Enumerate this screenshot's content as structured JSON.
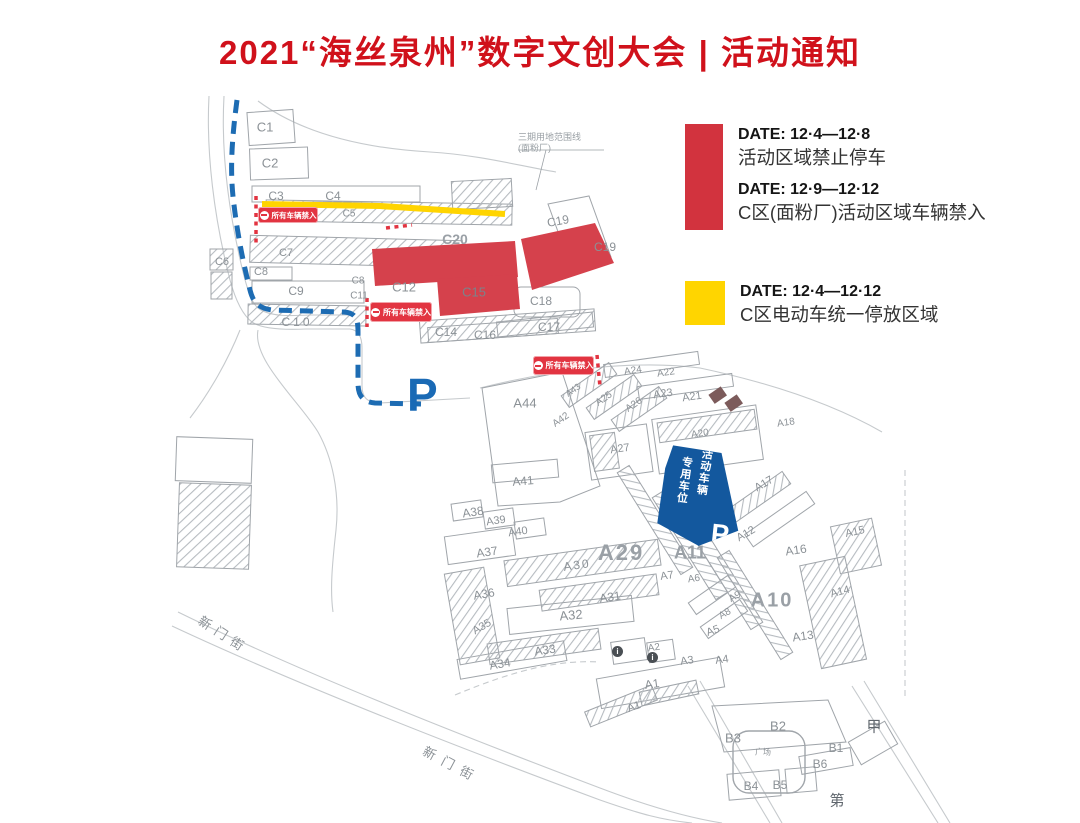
{
  "title": "2021“海丝泉州”数字文创大会 | 活动通知",
  "legend": {
    "no_parking": {
      "color": "#d2333e",
      "entries": [
        {
          "date": "DATE:  12·4—12·8",
          "desc": "活动区域禁止停车"
        },
        {
          "date": "DATE:  12·9—12·12",
          "desc": "C区(面粉厂)活动区域车辆禁入"
        }
      ]
    },
    "ebike": {
      "color": "#ffd500",
      "entries": [
        {
          "date": "DATE:  12·4—12·12",
          "desc": "C区电动车统一停放区域"
        }
      ]
    }
  },
  "map": {
    "no_entry_badge_label": "所有车辆禁入",
    "parking_zone": {
      "col_right": "活动车辆",
      "col_left": "专用车位",
      "p": "P"
    },
    "parking_marker": "P",
    "site_note_line1": "三期用地范围线",
    "site_note_line2": "(面粉厂)",
    "info_icon_glyph": "i",
    "colors": {
      "restricted_red": "#d5414c",
      "ebike_yellow": "#ffd400",
      "route_blue": "#1d6cb3"
    },
    "badges": [
      {
        "x": 258,
        "y": 207,
        "w": 60,
        "h": 16,
        "fs": 7.5
      },
      {
        "x": 370,
        "y": 302,
        "w": 62,
        "h": 20,
        "fs": 8
      },
      {
        "x": 533,
        "y": 356,
        "w": 61,
        "h": 19,
        "fs": 8
      }
    ],
    "info_icons": [
      {
        "x": 612,
        "y": 646
      },
      {
        "x": 647,
        "y": 652
      }
    ],
    "labels": [
      {
        "t": "C1",
        "x": 265,
        "y": 127,
        "s": 13
      },
      {
        "t": "C2",
        "x": 270,
        "y": 163,
        "s": 13
      },
      {
        "t": "C3",
        "x": 276,
        "y": 196,
        "s": 12
      },
      {
        "t": "C4",
        "x": 333,
        "y": 196,
        "s": 12
      },
      {
        "t": "C5",
        "x": 349,
        "y": 214,
        "s": 10
      },
      {
        "t": "C6",
        "x": 222,
        "y": 262,
        "s": 11
      },
      {
        "t": "C7",
        "x": 286,
        "y": 253,
        "s": 11
      },
      {
        "t": "C8",
        "x": 261,
        "y": 272,
        "s": 11
      },
      {
        "t": "C8",
        "x": 358,
        "y": 281,
        "s": 10
      },
      {
        "t": "C9",
        "x": 296,
        "y": 291,
        "s": 12
      },
      {
        "t": "C10",
        "x": 297,
        "y": 322,
        "s": 12,
        "ls": 3
      },
      {
        "t": "C11",
        "x": 359,
        "y": 296,
        "s": 10
      },
      {
        "t": "C12",
        "x": 404,
        "y": 287,
        "s": 13
      },
      {
        "t": "C14",
        "x": 446,
        "y": 332,
        "s": 12
      },
      {
        "t": "C15",
        "x": 474,
        "y": 292,
        "s": 13,
        "c": "#7c828a"
      },
      {
        "t": "C16",
        "x": 485,
        "y": 335,
        "s": 12
      },
      {
        "t": "C17",
        "x": 549,
        "y": 327,
        "s": 12
      },
      {
        "t": "C18",
        "x": 541,
        "y": 301,
        "s": 12
      },
      {
        "t": "C19",
        "x": 558,
        "y": 221,
        "s": 12,
        "r": -10
      },
      {
        "t": "C19",
        "x": 605,
        "y": 247,
        "s": 12
      },
      {
        "t": "C20",
        "x": 455,
        "y": 239,
        "s": 14,
        "b": true
      },
      {
        "t": "A44",
        "x": 525,
        "y": 403,
        "s": 13
      },
      {
        "t": "A24",
        "x": 633,
        "y": 371,
        "s": 10,
        "r": -8
      },
      {
        "t": "A22",
        "x": 666,
        "y": 373,
        "s": 10,
        "r": -8
      },
      {
        "t": "A23",
        "x": 663,
        "y": 394,
        "s": 11,
        "r": -8
      },
      {
        "t": "A21",
        "x": 692,
        "y": 397,
        "s": 11,
        "r": -8
      },
      {
        "t": "A43",
        "x": 573,
        "y": 390,
        "s": 9,
        "r": -35
      },
      {
        "t": "A25",
        "x": 604,
        "y": 399,
        "s": 10,
        "r": -35
      },
      {
        "t": "A26",
        "x": 634,
        "y": 405,
        "s": 10,
        "r": -35
      },
      {
        "t": "A42",
        "x": 561,
        "y": 420,
        "s": 10,
        "r": -35
      },
      {
        "t": "A27",
        "x": 620,
        "y": 449,
        "s": 11,
        "r": -8
      },
      {
        "t": "A20",
        "x": 700,
        "y": 434,
        "s": 10,
        "r": -8
      },
      {
        "t": "A18",
        "x": 786,
        "y": 423,
        "s": 10,
        "r": -8
      },
      {
        "t": "A17",
        "x": 764,
        "y": 484,
        "s": 11,
        "r": -30
      },
      {
        "t": "A12",
        "x": 746,
        "y": 534,
        "s": 11,
        "r": -30
      },
      {
        "t": "A16",
        "x": 796,
        "y": 550,
        "s": 12,
        "r": -8
      },
      {
        "t": "A15",
        "x": 855,
        "y": 532,
        "s": 11,
        "r": -12
      },
      {
        "t": "A14",
        "x": 840,
        "y": 592,
        "s": 11,
        "r": -15
      },
      {
        "t": "A13",
        "x": 803,
        "y": 636,
        "s": 12,
        "r": -8
      },
      {
        "t": "A10",
        "x": 772,
        "y": 601,
        "s": 20,
        "b": true,
        "ls": 2
      },
      {
        "t": "A11",
        "x": 690,
        "y": 553,
        "s": 18,
        "b": true
      },
      {
        "t": "A29",
        "x": 621,
        "y": 553,
        "s": 22,
        "b": true,
        "ls": 2
      },
      {
        "t": "A30",
        "x": 577,
        "y": 565,
        "s": 12,
        "r": -8,
        "ls": 2
      },
      {
        "t": "A31",
        "x": 610,
        "y": 597,
        "s": 12,
        "r": -8
      },
      {
        "t": "A32",
        "x": 571,
        "y": 615,
        "s": 13,
        "r": -5
      },
      {
        "t": "A33",
        "x": 545,
        "y": 650,
        "s": 12,
        "r": -8
      },
      {
        "t": "A34",
        "x": 500,
        "y": 664,
        "s": 12,
        "r": -10
      },
      {
        "t": "A35",
        "x": 482,
        "y": 627,
        "s": 11,
        "r": -30
      },
      {
        "t": "A36",
        "x": 484,
        "y": 594,
        "s": 12,
        "r": -10
      },
      {
        "t": "A37",
        "x": 487,
        "y": 552,
        "s": 12,
        "r": -8
      },
      {
        "t": "A38",
        "x": 473,
        "y": 512,
        "s": 12,
        "r": -8
      },
      {
        "t": "A39",
        "x": 496,
        "y": 521,
        "s": 11,
        "r": -8
      },
      {
        "t": "A40",
        "x": 518,
        "y": 532,
        "s": 11,
        "r": -8
      },
      {
        "t": "A41",
        "x": 523,
        "y": 481,
        "s": 12,
        "r": -5
      },
      {
        "t": "A9",
        "x": 735,
        "y": 597,
        "s": 10,
        "r": -30
      },
      {
        "t": "A8",
        "x": 725,
        "y": 614,
        "s": 10,
        "r": -30
      },
      {
        "t": "A7",
        "x": 667,
        "y": 576,
        "s": 11,
        "r": -8
      },
      {
        "t": "A6",
        "x": 694,
        "y": 579,
        "s": 10,
        "r": -8
      },
      {
        "t": "A5",
        "x": 713,
        "y": 631,
        "s": 11,
        "r": -20
      },
      {
        "t": "A4",
        "x": 722,
        "y": 660,
        "s": 11,
        "r": -8
      },
      {
        "t": "A3",
        "x": 687,
        "y": 661,
        "s": 11,
        "r": -8
      },
      {
        "t": "A2",
        "x": 654,
        "y": 648,
        "s": 10,
        "r": -8
      },
      {
        "t": "A1",
        "x": 652,
        "y": 684,
        "s": 12,
        "r": -8
      },
      {
        "t": "A1",
        "x": 634,
        "y": 707,
        "s": 11,
        "r": -20
      },
      {
        "t": "B2",
        "x": 778,
        "y": 726,
        "s": 13
      },
      {
        "t": "B3",
        "x": 733,
        "y": 738,
        "s": 13
      },
      {
        "t": "B1",
        "x": 836,
        "y": 748,
        "s": 12
      },
      {
        "t": "B6",
        "x": 820,
        "y": 764,
        "s": 12
      },
      {
        "t": "B4",
        "x": 751,
        "y": 786,
        "s": 12
      },
      {
        "t": "B5",
        "x": 780,
        "y": 785,
        "s": 12
      },
      {
        "t": "广场",
        "x": 763,
        "y": 752,
        "s": 8
      },
      {
        "t": "甲",
        "x": 874,
        "y": 726,
        "s": 15,
        "c": "#5f666d"
      },
      {
        "t": "第",
        "x": 837,
        "y": 800,
        "s": 15,
        "c": "#5f666d"
      },
      {
        "t": "新门街",
        "x": 224,
        "y": 634,
        "s": 13,
        "r": 33,
        "ls": 6
      },
      {
        "t": "新门街",
        "x": 452,
        "y": 764,
        "s": 13,
        "r": 28,
        "ls": 8
      }
    ]
  }
}
